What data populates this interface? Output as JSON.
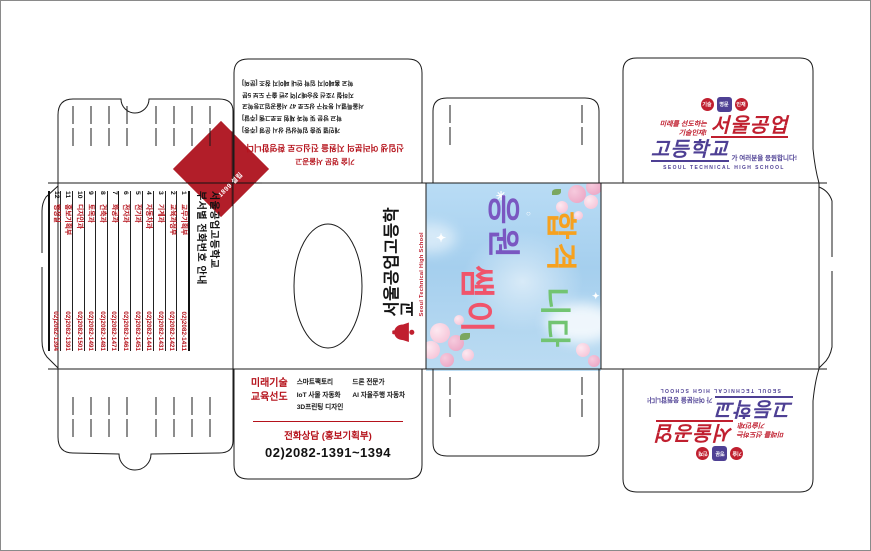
{
  "diamond": {
    "label": "1899 설립"
  },
  "left_panel": {
    "title_line1": "서울공업고등학교",
    "title_line2": "부서별 전화번호 안내",
    "rows": [
      {
        "no": "1",
        "dept": "교무기획부",
        "phone": "02)2082-1411"
      },
      {
        "no": "2",
        "dept": "교육과정부",
        "phone": "02)2082-1421"
      },
      {
        "no": "3",
        "dept": "기계과",
        "phone": "02)2082-1431"
      },
      {
        "no": "4",
        "dept": "자동차과",
        "phone": "02)2082-1441"
      },
      {
        "no": "5",
        "dept": "전기과",
        "phone": "02)2082-1451"
      },
      {
        "no": "6",
        "dept": "전자과",
        "phone": "02)2082-1461"
      },
      {
        "no": "7",
        "dept": "화공과",
        "phone": "02)2082-1471"
      },
      {
        "no": "8",
        "dept": "건축과",
        "phone": "02)2082-1481"
      },
      {
        "no": "9",
        "dept": "토목과",
        "phone": "02)2082-1491"
      },
      {
        "no": "10",
        "dept": "디자인과",
        "phone": "02)2082-1501"
      },
      {
        "no": "11",
        "dept": "홍보기획부",
        "phone": "02)2082-1391"
      },
      {
        "no": "12",
        "dept": "행정실",
        "phone": "02)2082-1394"
      }
    ]
  },
  "center_panel": {
    "school_ko": "서울공업고등학교",
    "school_en": "Seoul Technical High School"
  },
  "top_flap": {
    "red_lines": [
      "기술 명문 서울공고",
      "신입생 여러분의 지원을 진심으로 환영합니다"
    ],
    "black_lines": [
      "개인별 맞춤 입학상담 상시 운영 [주중]",
      "학교 방문 및 학과 체험 프로그램 [주말]",
      "서울특별시 동작구 상도로 47 서울공업고등학교",
      "지하철 7호선 장승배기역 2번 출구 도보 5분",
      "학교 홈페이지 입학 안내 페이지 참조 [문의]"
    ]
  },
  "bottom_flap": {
    "highlight_line1": "미래기술",
    "highlight_line2": "교육선도",
    "col1": [
      "스마트팩토리",
      "IoT 사물 자동화",
      "3D프린팅 디자인"
    ],
    "col2": [
      "드론 전문가",
      "AI 자율주행 자동차"
    ],
    "contact_title": "전화상담 (홍보기획부)",
    "contact_phone": "02)2082-1391~1394"
  },
  "logo": {
    "badges": [
      {
        "text": "기술",
        "color": "#c01f2f"
      },
      {
        "text": "명문",
        "color": "#4e4094"
      },
      {
        "text": "인재",
        "color": "#c01f2f"
      }
    ],
    "tagline_line1": "미래를 선도하는",
    "tagline_line2": "기술인재!",
    "big_red": "서울공업",
    "big_purple": "고등학교",
    "tail": "가 여러분을 응원합니다!",
    "sub": "SEOUL TECHNICAL HIGH SCHOOL"
  },
  "print_panel": {
    "words": [
      {
        "text": "응원",
        "color": "#7a57c1"
      },
      {
        "text": "쌤이",
        "color": "#f0546b"
      },
      {
        "text": "합격",
        "color": "#f6a11f"
      },
      {
        "text": "니다",
        "color": "#72c472"
      }
    ]
  },
  "colors": {
    "brand_red": "#b5121b",
    "diamond_red": "#b21e29",
    "logo_red": "#c01f2f",
    "logo_purple": "#4e4094",
    "panel_blue": "#a5cfee",
    "dieline": "#1b1b1b"
  }
}
